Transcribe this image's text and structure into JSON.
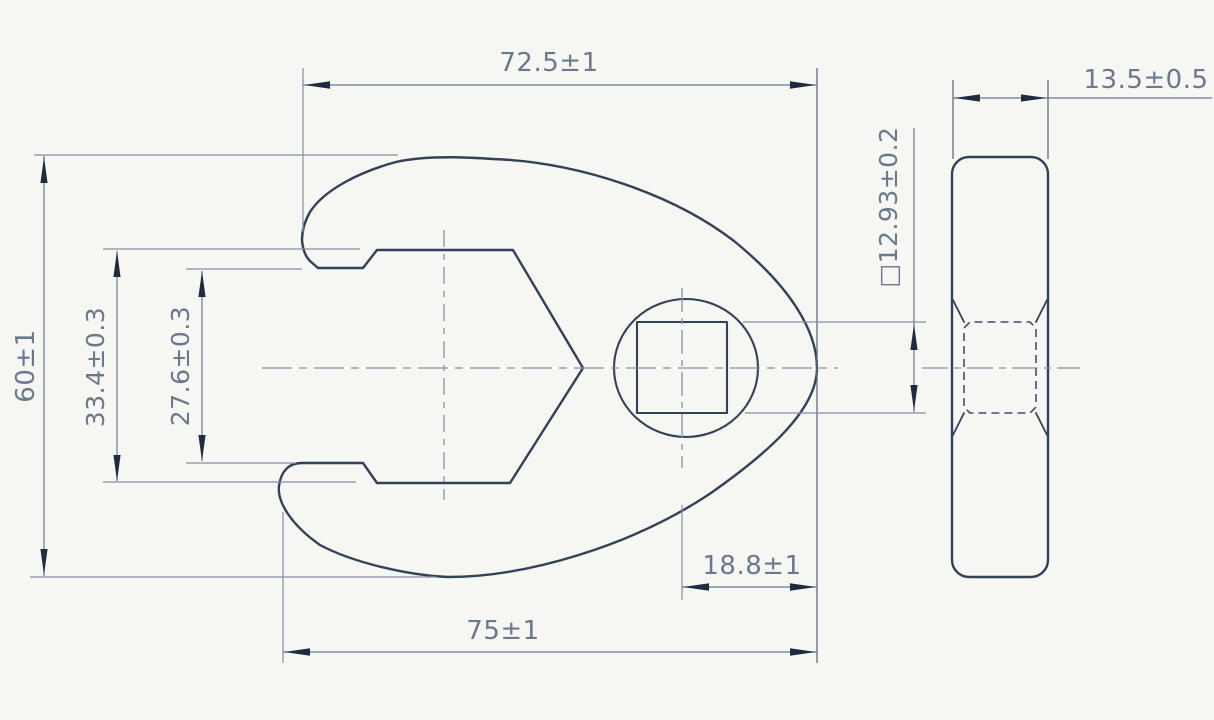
{
  "dimensions": {
    "top_width": "72.5±1",
    "side_thickness": "13.5±0.5",
    "overall_height": "60±1",
    "jaw_width_outer": "33.4±0.3",
    "jaw_width_inner": "27.6±0.3",
    "square_drive": "□12.93±0.2",
    "drive_center_to_edge": "18.8±1",
    "bottom_width": "75±1"
  },
  "colors": {
    "background": "#f6f6f3",
    "body_outline": "#32415a",
    "hidden_line": "#41516b",
    "dimension_line": "#6b7a92",
    "centerline": "#8593a9",
    "arrowhead": "#1f2c40",
    "label_text": "#6a7890"
  }
}
